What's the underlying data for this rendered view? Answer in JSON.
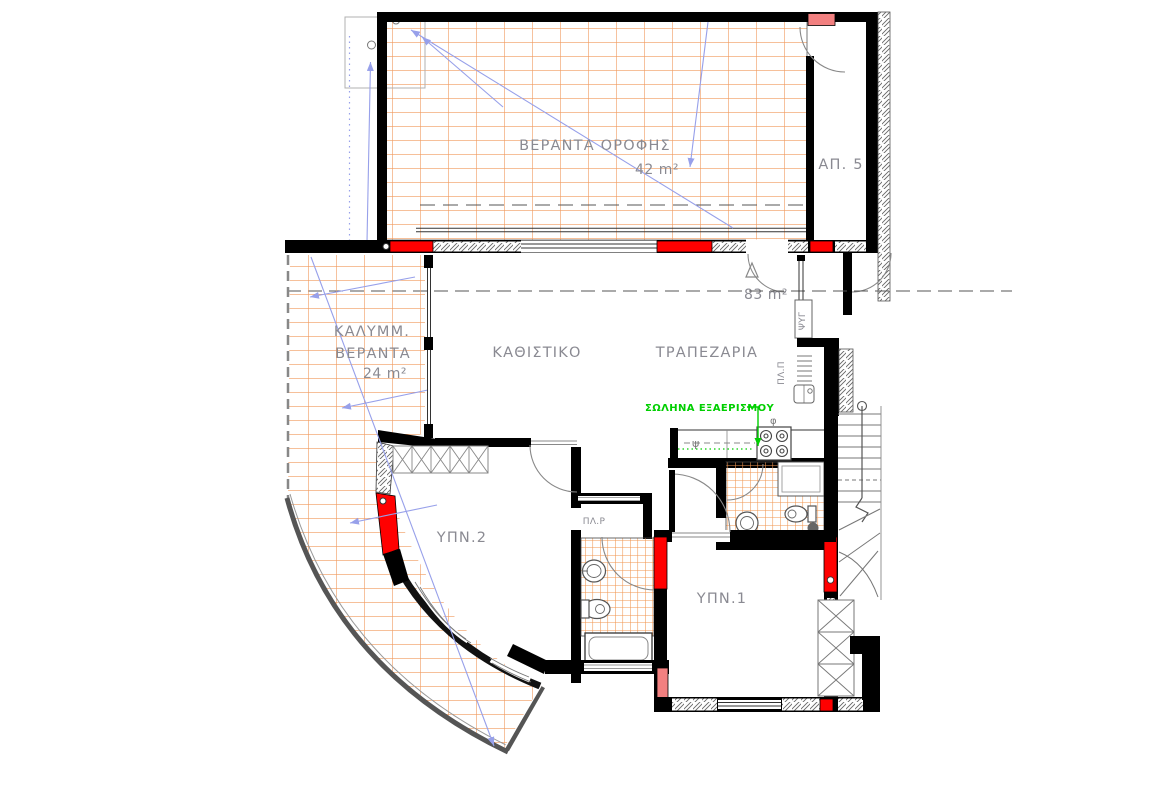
{
  "drawing": {
    "type": "architectural-floor-plan",
    "colors": {
      "hatch_orange": "#F09A5E",
      "wall_black": "#000000",
      "column_red": "#FF0000",
      "column_pink": "#F28080",
      "arrow_blue": "#97A0EA",
      "vent_green": "#00CF00",
      "label_gray": "#8A8A92"
    },
    "rooms": {
      "roof_veranda": {
        "name": "ΒΕΡΑΝΤΑ ΟΡΟΦΗΣ",
        "area": "42 m²"
      },
      "apartment5": {
        "name": "ΑΠ. 5"
      },
      "apartment_area": "83 m²",
      "covered_veranda": {
        "name_line1": "ΚΑΛΥΜΜ.",
        "name_line2": "ΒΕΡΑΝΤΑ",
        "area": "24 m²"
      },
      "living_room": {
        "name": "ΚΑΘΙΣΤΙΚΟ"
      },
      "dining_room": {
        "name": "ΤΡΑΠΕΖΑΡΙΑ"
      },
      "bedroom1": {
        "name": "ΥΠΝ.1"
      },
      "bedroom2": {
        "name": "ΥΠΝ.2"
      },
      "laundry": {
        "name": "ΠΛ.Ρ"
      }
    },
    "annotations": {
      "vent_pipe": "ΣΩΛΗΝΑ ΕΞΑΕΡΙΣΜΟΥ",
      "fridge": "ΨΥΓ",
      "dishwasher": "ΠΛ.Π",
      "sink_symbol": "ψ",
      "drain_symbol": "φ"
    }
  }
}
